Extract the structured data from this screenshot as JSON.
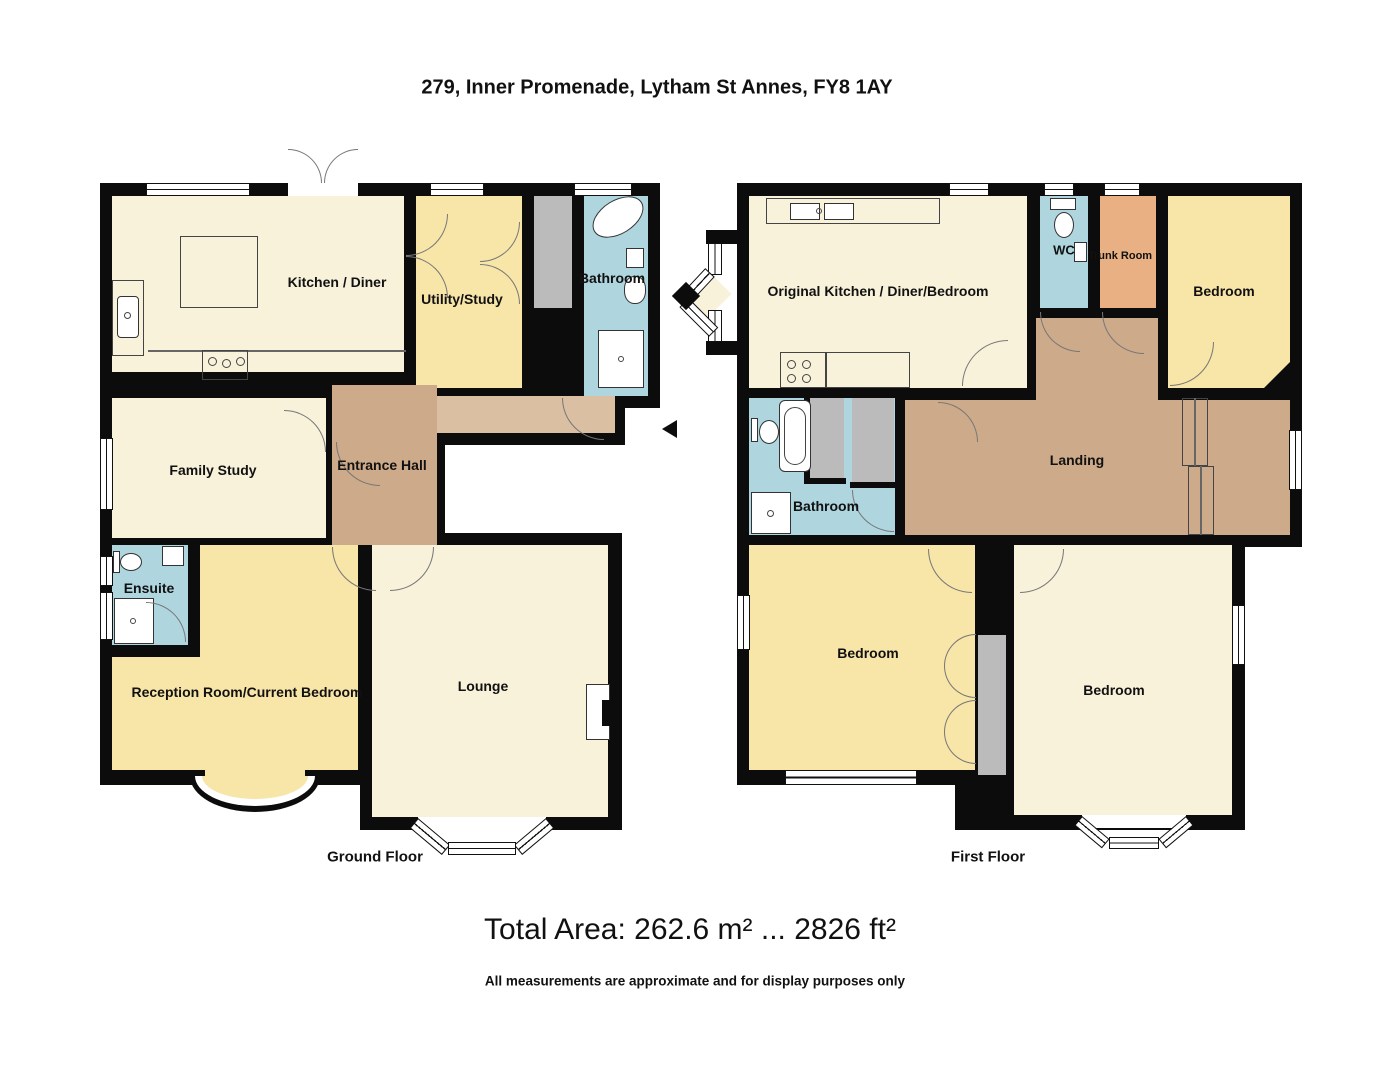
{
  "title": "279, Inner Promenade, Lytham St Annes, FY8 1AY",
  "ground_floor": {
    "caption": "Ground Floor",
    "rooms": [
      {
        "name": "kitchen-diner",
        "label": "Kitchen / Diner"
      },
      {
        "name": "utility-study",
        "label": "Utility/Study"
      },
      {
        "name": "bathroom",
        "label": "Bathroom"
      },
      {
        "name": "family-study",
        "label": "Family Study"
      },
      {
        "name": "entrance-hall",
        "label": "Entrance Hall"
      },
      {
        "name": "ensuite",
        "label": "Ensuite"
      },
      {
        "name": "reception-room",
        "label": "Reception Room/Current Bedroom"
      },
      {
        "name": "lounge",
        "label": "Lounge"
      }
    ]
  },
  "first_floor": {
    "caption": "First Floor",
    "rooms": [
      {
        "name": "original-kitchen",
        "label": "Original Kitchen / Diner/Bedroom"
      },
      {
        "name": "wc",
        "label": "WC"
      },
      {
        "name": "trunk-room",
        "label": "Trunk Room"
      },
      {
        "name": "bedroom-front",
        "label": "Bedroom"
      },
      {
        "name": "bathroom",
        "label": "Bathroom"
      },
      {
        "name": "landing",
        "label": "Landing"
      },
      {
        "name": "bedroom-left",
        "label": "Bedroom"
      },
      {
        "name": "bedroom-right",
        "label": "Bedroom"
      }
    ]
  },
  "footer": {
    "total_area": "Total Area: 262.6 m² ... 2826 ft²",
    "disclaimer": "All measurements are approximate and for display purposes only"
  },
  "colors": {
    "wall": "#0c0c0c",
    "cream": "#F8F2DB",
    "gold": "#F8E5A8",
    "blue": "#AFD6DF",
    "tan": "#CDAA89",
    "tan_light": "#DABFA3",
    "orange": "#E8B083",
    "grey": "#BBBBBB"
  }
}
